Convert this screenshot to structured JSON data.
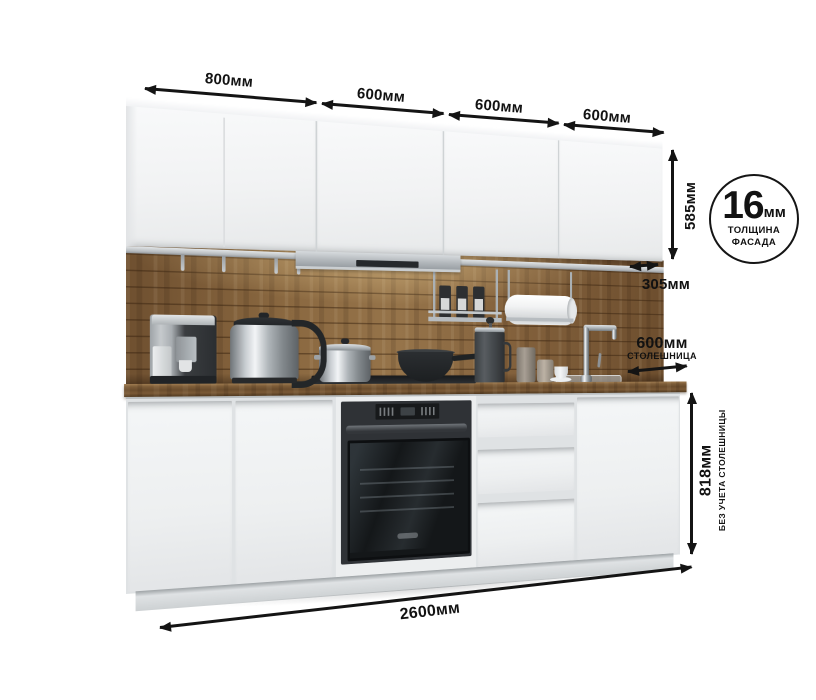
{
  "diagram": {
    "top_widths": [
      {
        "label": "800мм"
      },
      {
        "label": "600мм"
      },
      {
        "label": "600мм"
      },
      {
        "label": "600мм"
      }
    ],
    "upper_cabinet_height": "585мм",
    "upper_cabinet_depth": "305мм",
    "countertop": {
      "width": "600мм",
      "caption": "СТОЛЕШНИЦА"
    },
    "base_height": {
      "value": "818мм",
      "caption": "БЕЗ УЧЕТА СТОЛЕШНИЦЫ"
    },
    "total_width": "2600мм",
    "facade_badge": {
      "value": "16",
      "unit": "мм",
      "line1": "ТОЛЩИНА",
      "line2": "ФАСАДА"
    }
  },
  "colors": {
    "annotation": "#141414",
    "wood": "#83613c",
    "cabinet_white": "#f1f3f4",
    "hood_silver": "#b3b8bc",
    "oven_black": "#1b1e20"
  },
  "scene_items": [
    "upper-cabinets",
    "cooker-hood",
    "wood-backsplash",
    "rail-with-hooks",
    "spice-shelf",
    "paper-towel-holder",
    "coffee-machine",
    "electric-kettle",
    "stockpot",
    "wok-pan",
    "cooktop",
    "french-press",
    "canisters",
    "cup-and-saucer",
    "faucet",
    "sink",
    "countertop",
    "built-in-oven",
    "base-cabinets",
    "drawer-unit"
  ]
}
